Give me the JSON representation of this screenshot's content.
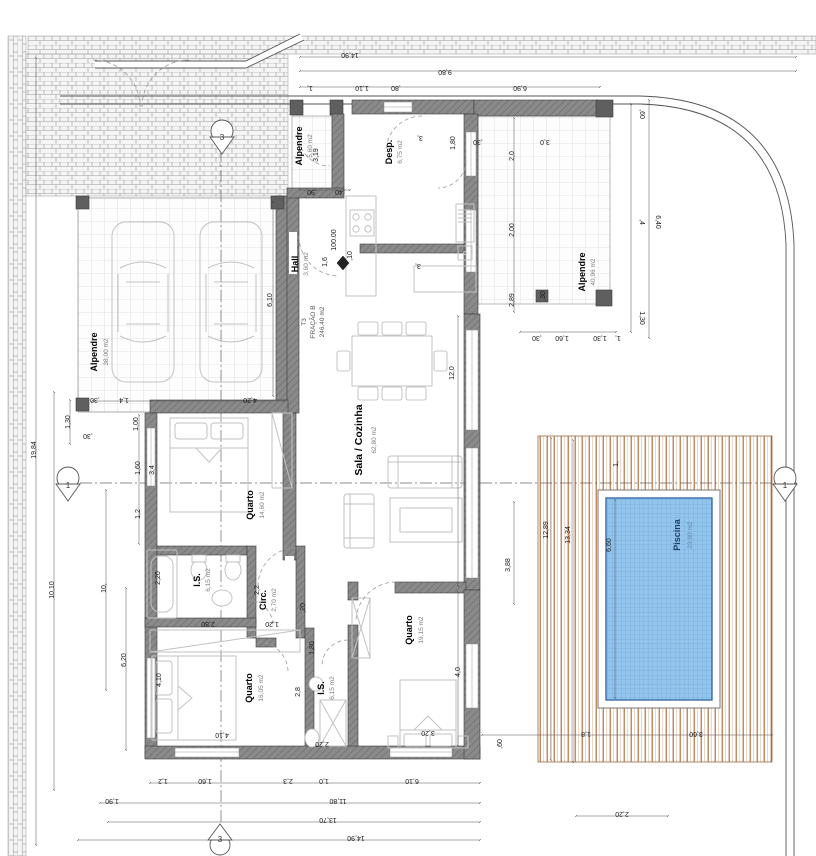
{
  "rooms": {
    "alpendre_garage": {
      "name": "Alpendre",
      "area": "38,00 m2"
    },
    "alpendre_entry": {
      "name": "Alpendre",
      "area": "5,60 m2"
    },
    "desp": {
      "name": "Desp.",
      "area": "6,75 m2"
    },
    "hall": {
      "name": "Hall",
      "area": "3,60 m2"
    },
    "fracao": {
      "l1": "T3",
      "l2": "FRAÇÃO B",
      "l3": "246,40 m2"
    },
    "sala": {
      "name": "Sala / Cozinha",
      "area": "62,80 m2"
    },
    "quarto1": {
      "name": "Quarto",
      "area": "14,60 m2"
    },
    "is1": {
      "name": "I.S.",
      "area": "6,15 m2"
    },
    "circ": {
      "name": "Circ.",
      "area": "2,70 m2"
    },
    "quarto2": {
      "name": "Quarto",
      "area": "16,05 m2"
    },
    "is2": {
      "name": "I.S.",
      "area": "6,15 m2"
    },
    "quarto3": {
      "name": "Quarto",
      "area": "19,15 m2"
    },
    "alpendre_right": {
      "name": "Alpendre",
      "area": "40,96 m2"
    },
    "piscina": {
      "name": "Piscina",
      "area": "23,80 m2"
    }
  },
  "markers": {
    "section_v": "3",
    "section_h": "1",
    "level": "100.00"
  },
  "colors": {
    "wall": "#8a8a8a",
    "wall_hatch": "#6e6e6e",
    "tile_line": "#cccccc",
    "brick_line": "#9a9a9a",
    "deck_stripe": "#b4622d",
    "pool_fill": "#92c4ec",
    "pool_grid": "#69a6d6",
    "pool_border": "#3a6ea8",
    "piscina_label": "#1c3f66",
    "piscina_area": "#6c89ad"
  },
  "dims": [
    {
      "t": "14,90"
    },
    {
      "t": "9,80"
    },
    {
      "t": "1,"
    },
    {
      "t": "1,10"
    },
    {
      "t": ",80"
    },
    {
      "t": "6,90"
    },
    {
      "t": ",60"
    },
    {
      "t": "6,40"
    },
    {
      "t": ",4"
    },
    {
      "t": "1,30"
    },
    {
      "t": ",30"
    },
    {
      "t": "1,60"
    },
    {
      "t": "1,30"
    },
    {
      "t": "2,0"
    },
    {
      "t": "2,00"
    },
    {
      "t": "2,89"
    },
    {
      "t": "3,0"
    },
    {
      "t": "1,80"
    },
    {
      "t": "3,"
    },
    {
      "t": ",30"
    },
    {
      "t": "19,84"
    },
    {
      "t": "10,10"
    },
    {
      "t": "10,"
    },
    {
      "t": "6,20"
    },
    {
      "t": "1,30"
    },
    {
      "t": ",30"
    },
    {
      "t": "1,4"
    },
    {
      "t": "4,20"
    },
    {
      "t": ",30"
    },
    {
      "t": "6,10"
    },
    {
      "t": "1,00"
    },
    {
      "t": "1,60"
    },
    {
      "t": "1,2"
    },
    {
      "t": "3,4"
    },
    {
      "t": "2,20"
    },
    {
      "t": "2,80"
    },
    {
      "t": "1,20"
    },
    {
      "t": ",20"
    },
    {
      "t": "2,2"
    },
    {
      "t": "4,10"
    },
    {
      "t": "4,10"
    },
    {
      "t": "1,80"
    },
    {
      "t": "2,20"
    },
    {
      "t": "3,20"
    },
    {
      "t": "4,0"
    },
    {
      "t": "12,0"
    },
    {
      "t": "3,88"
    },
    {
      "t": "6,60"
    },
    {
      "t": "12,89"
    },
    {
      "t": "13,34"
    },
    {
      "t": "1,"
    },
    {
      "t": "3,60"
    },
    {
      "t": "1,8"
    },
    {
      "t": ",60"
    },
    {
      "t": "2,20"
    },
    {
      "t": "1,2"
    },
    {
      "t": "1,60"
    },
    {
      "t": "2,3"
    },
    {
      "t": "1,0"
    },
    {
      "t": "6,10"
    },
    {
      "t": "1,90"
    },
    {
      "t": "11,80"
    },
    {
      "t": "13,70"
    },
    {
      "t": "14,90"
    },
    {
      "t": "3,19"
    },
    {
      "t": ",90"
    },
    {
      "t": ",40"
    },
    {
      "t": "1,6"
    },
    {
      "t": ",10"
    },
    {
      "t": "3,"
    },
    {
      "t": "2,8"
    },
    {
      "t": ",30"
    },
    {
      "t": "1,"
    }
  ]
}
